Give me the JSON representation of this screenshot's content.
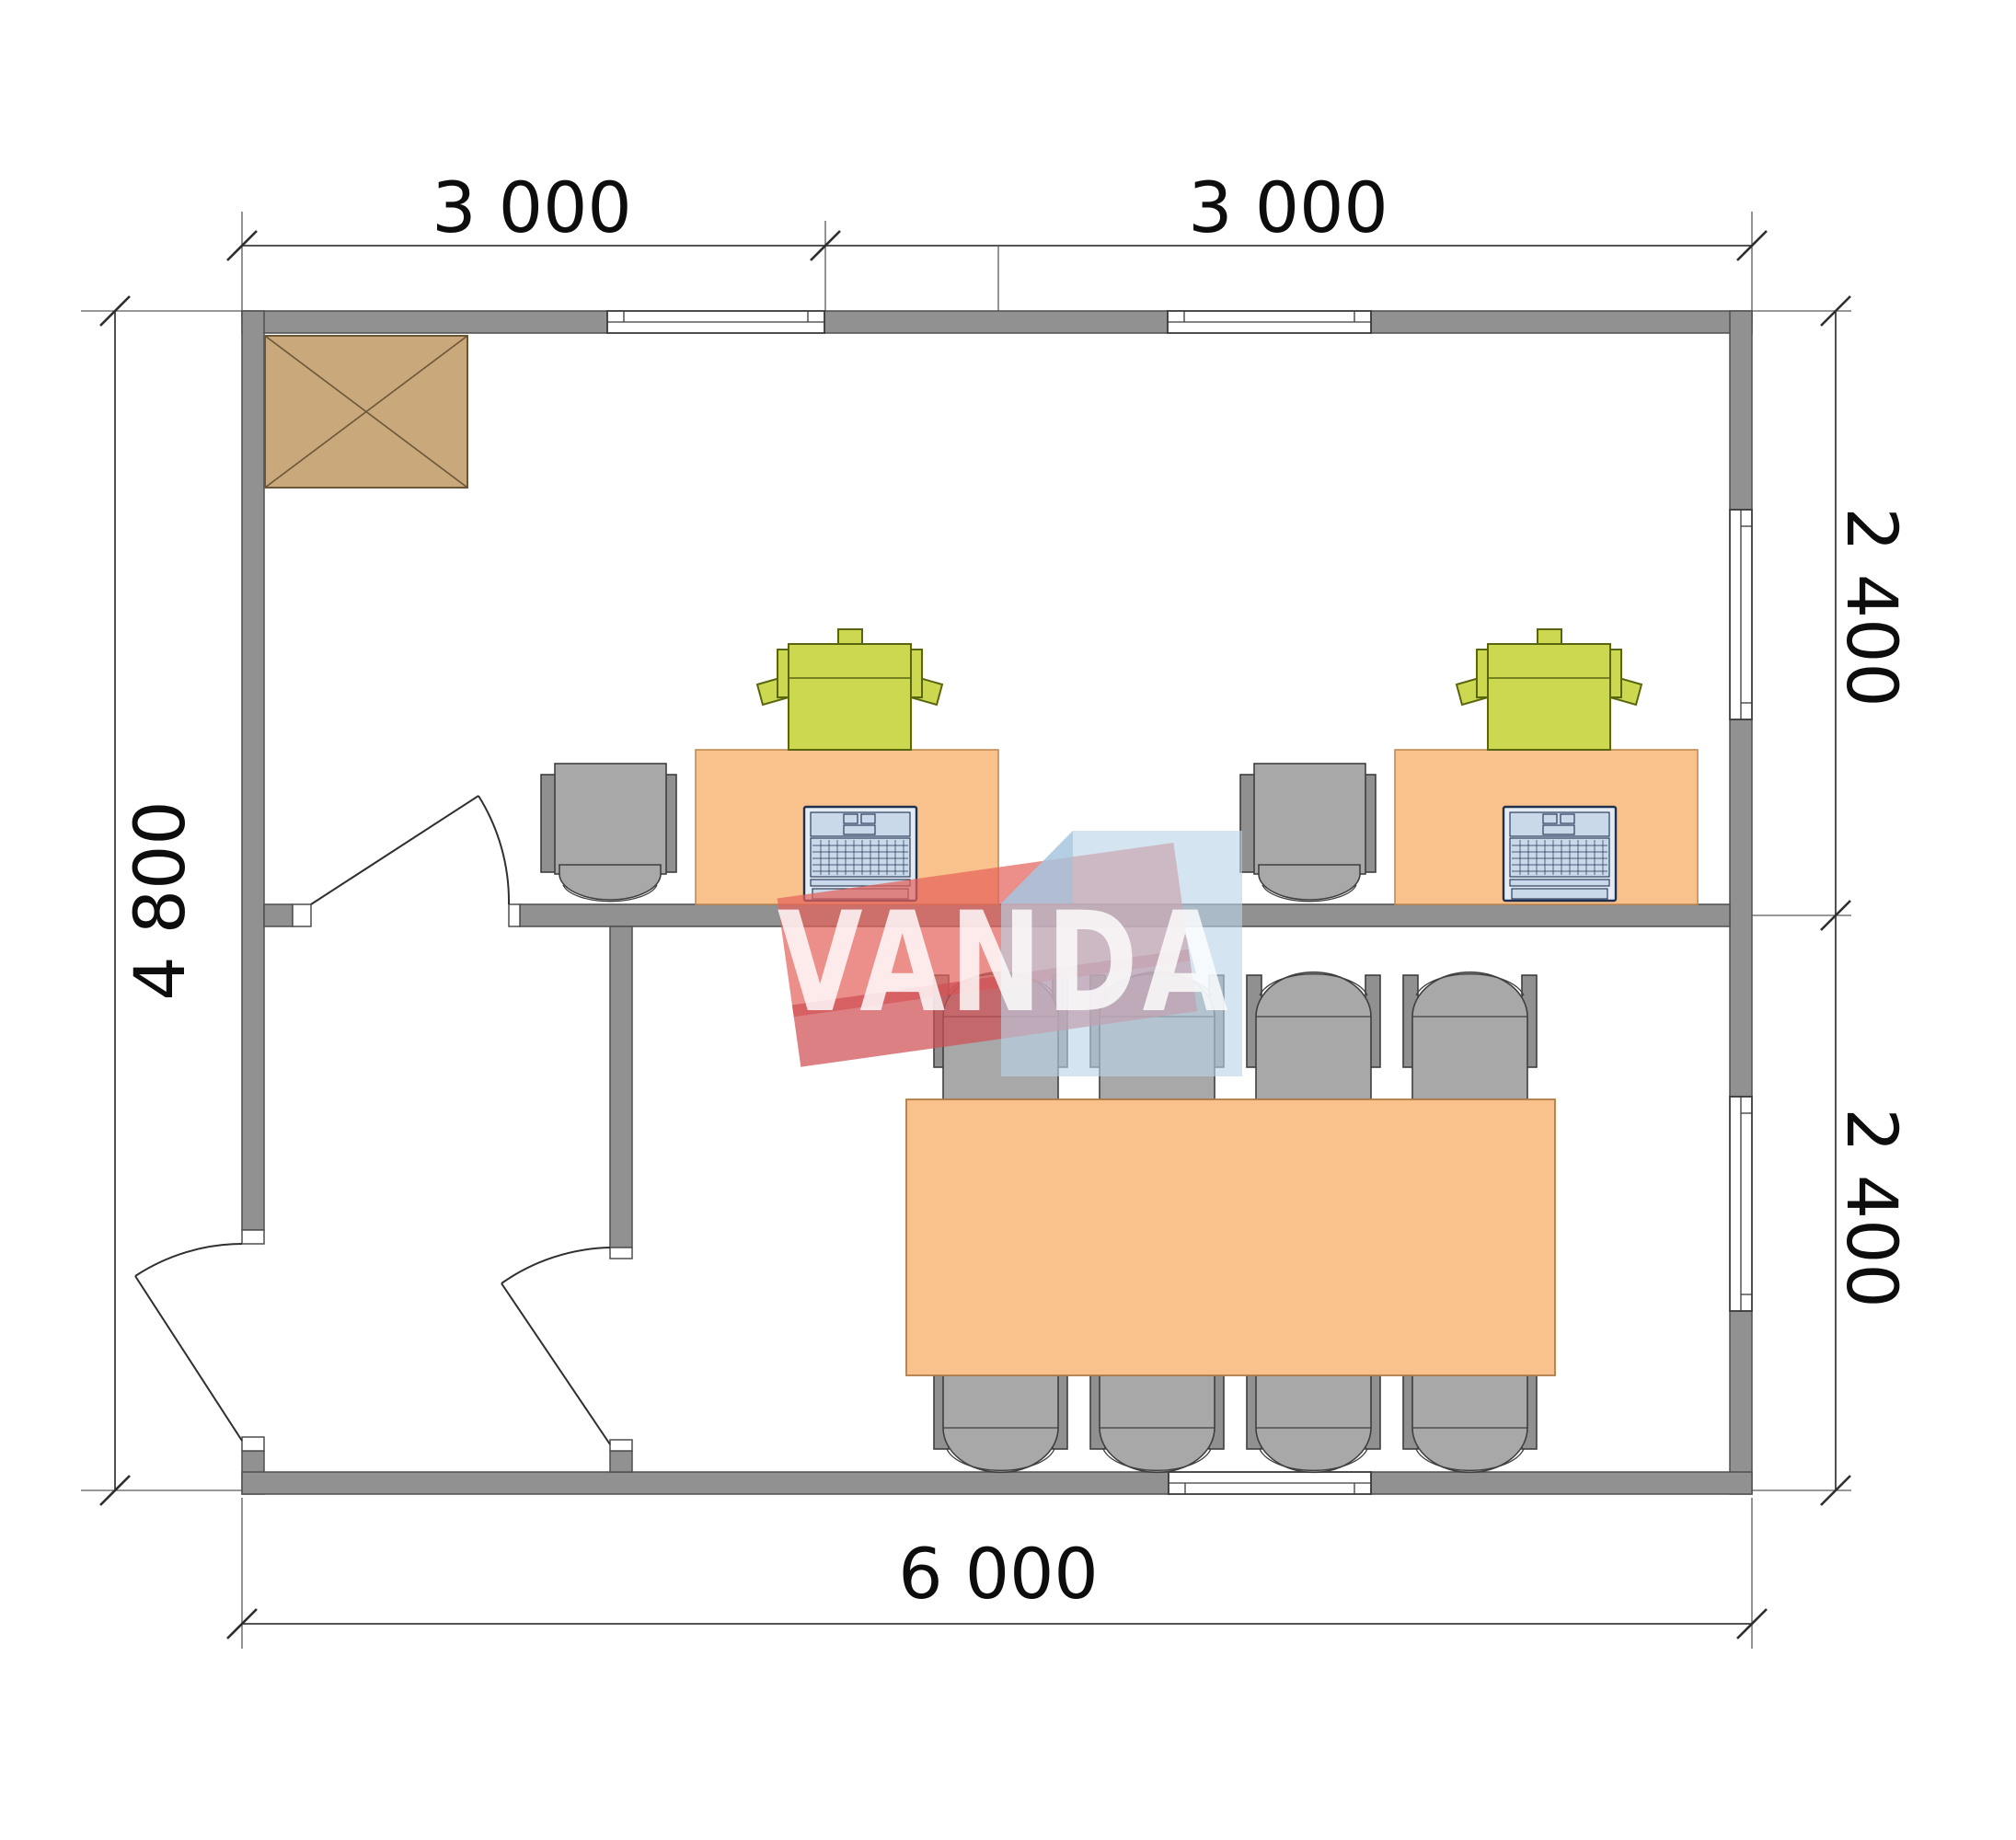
{
  "drawing": {
    "type": "floor-plan",
    "description": "Office cabin plan 6000 x 4800 mm, two rooms: office with two desks and meeting room with table for eight"
  },
  "watermark": {
    "text": "VANDA"
  },
  "dimensions": {
    "top": [
      {
        "label": "3 000"
      },
      {
        "label": "3 000"
      }
    ],
    "right": [
      {
        "label": "2 400"
      },
      {
        "label": "2 400"
      }
    ],
    "left": {
      "label": "4 800"
    },
    "bottom": {
      "label": "6 000"
    }
  },
  "inventory": {
    "desks": 2,
    "office_chairs": 2,
    "printers": 2,
    "laptops": 2,
    "meeting_table": 1,
    "meeting_chairs": 8,
    "cabinet_boxes": 1,
    "doors": 3,
    "windows": 5
  },
  "colors": {
    "wall": "#919191",
    "cabinet": "#c9a87c",
    "desk": "#f9c28c",
    "chair": "#a8a8a8",
    "chairdark": "#909090",
    "printer": "#ccd850",
    "laptopbody": "#e3ecf5",
    "laptopscreen": "#c9d9ea",
    "laptopdark": "#20304f",
    "wmred": "#e4625c",
    "wmreddark": "#cf4f55",
    "wmblue": "#b9d3e8",
    "wmbluedark": "#9fc0dc"
  }
}
